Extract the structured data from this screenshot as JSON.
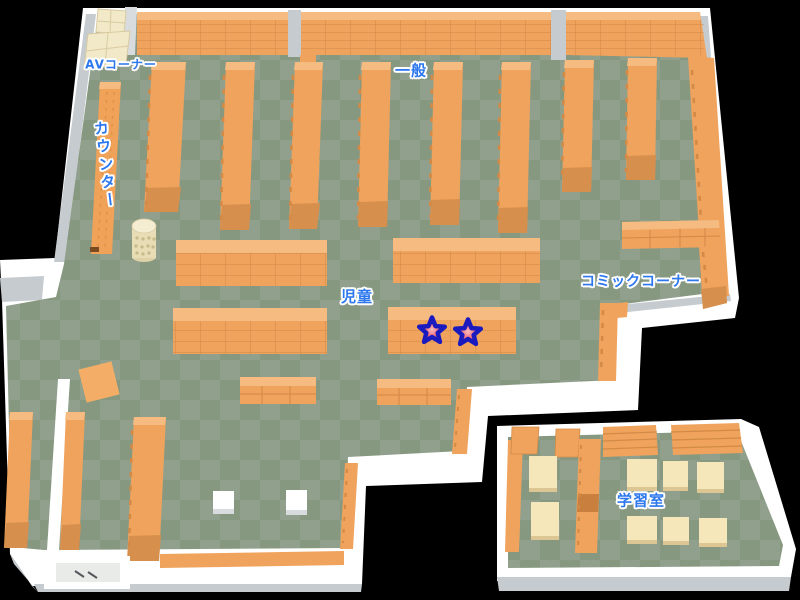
{
  "map_title": "library-floor-map",
  "colors": {
    "background": "#000000",
    "floor_light": "#90A08C",
    "floor_dark": "#879880",
    "wall_white": "#FFFFFF",
    "wall_gray": "#C6CBCF",
    "shelf_orange": "#EFA35D",
    "shelf_orange_light": "#F6BB80",
    "shelf_orange_dark": "#D68F4D",
    "shelf_line": "#D28A46",
    "cream": "#F2E9C8",
    "desk_cream": "#F6E7BA",
    "label_blue": "#2C77EE",
    "star_outline": "#1A1ABE",
    "star_fill": "#E23C52",
    "star_center": "#F8BCBE"
  },
  "labels": [
    {
      "id": "av-corner",
      "text": "AVコーナー",
      "x": 121,
      "y": 64,
      "size": 12,
      "orientation": "horizontal"
    },
    {
      "id": "counter",
      "text": "カウンター",
      "x": 106,
      "y": 165,
      "size": 15,
      "orientation": "vertical"
    },
    {
      "id": "general",
      "text": "一般",
      "x": 411,
      "y": 70,
      "size": 15,
      "orientation": "horizontal"
    },
    {
      "id": "children",
      "text": "児童",
      "x": 357,
      "y": 296,
      "size": 15,
      "orientation": "horizontal"
    },
    {
      "id": "comic-corner",
      "text": "コミックコーナー",
      "x": 641,
      "y": 281,
      "size": 14,
      "orientation": "horizontal"
    },
    {
      "id": "study-room",
      "text": "学習室",
      "x": 641,
      "y": 500,
      "size": 15,
      "orientation": "horizontal"
    }
  ],
  "markers": [
    {
      "id": "star-marker-1",
      "x": 432,
      "y": 331
    },
    {
      "id": "star-marker-2",
      "x": 468,
      "y": 333
    }
  ]
}
